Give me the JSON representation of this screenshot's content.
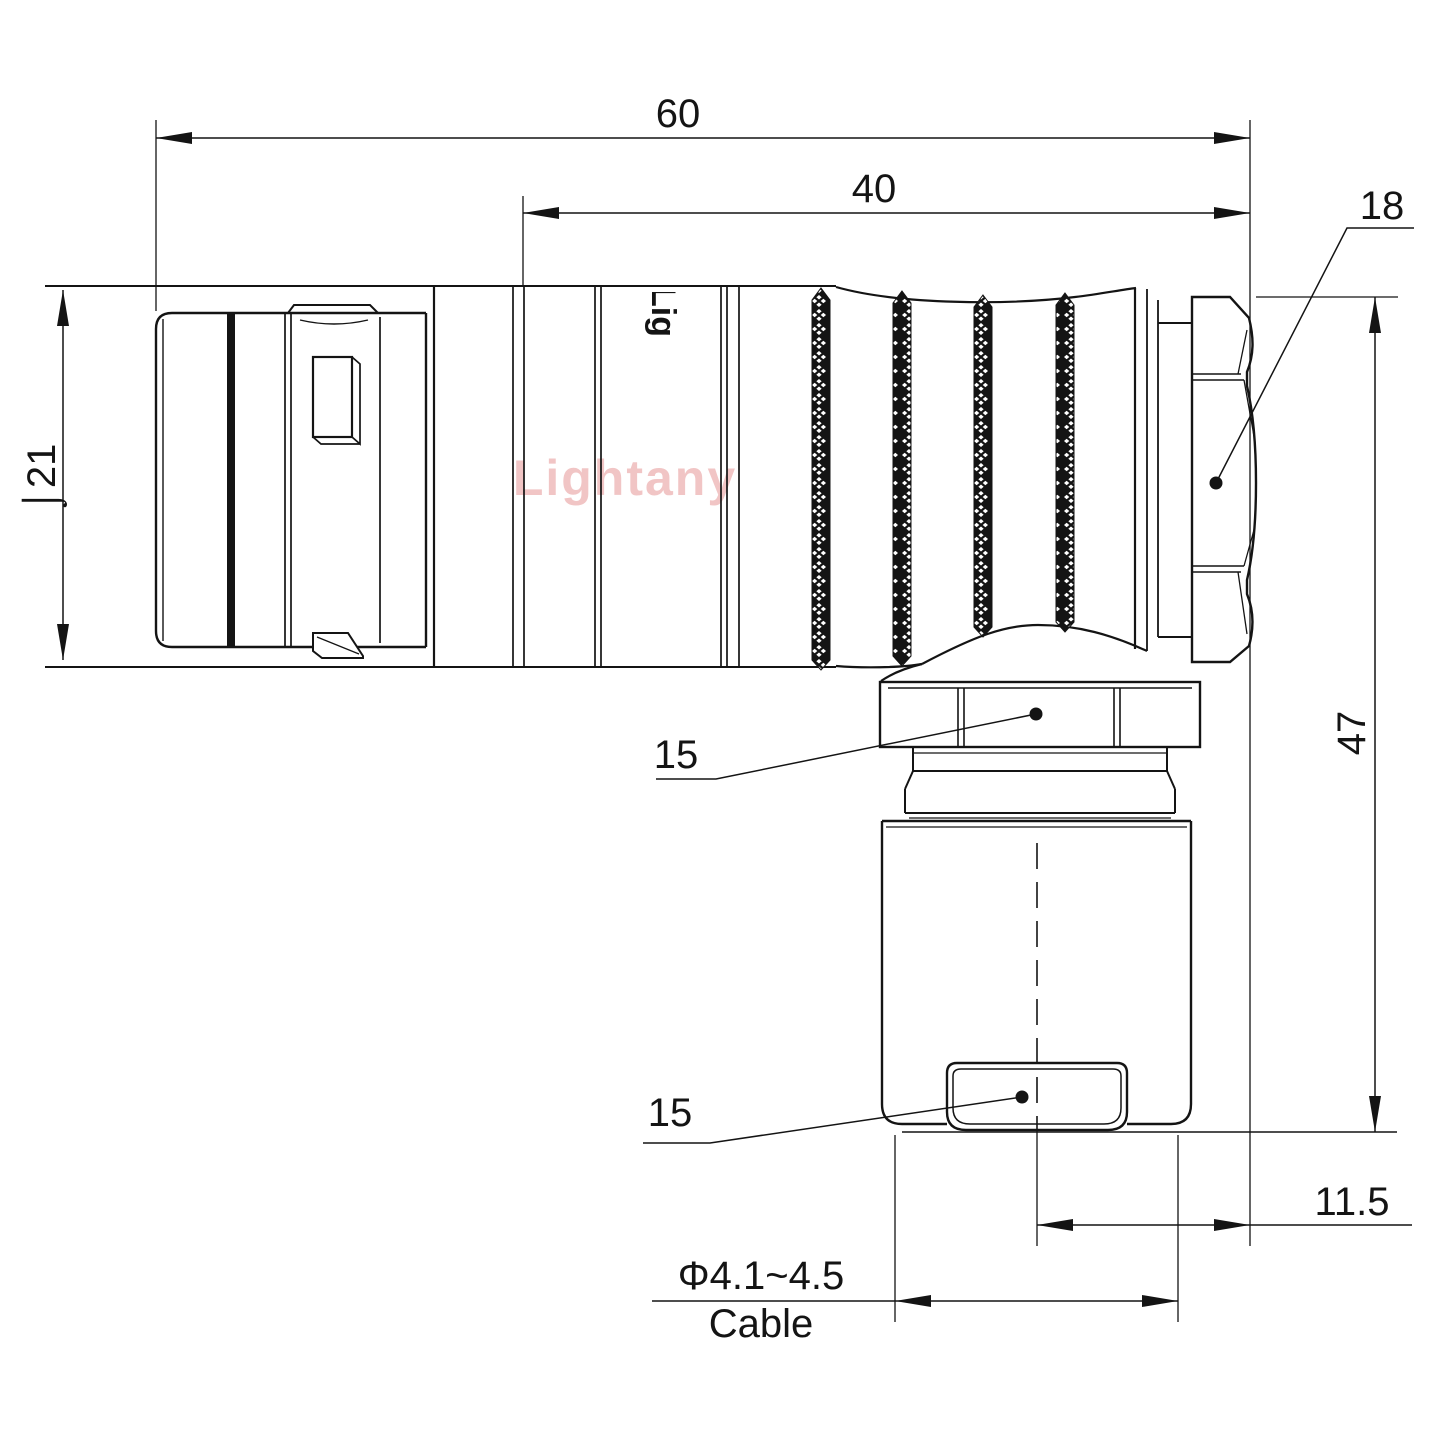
{
  "watermark": {
    "text": "Lightany",
    "color": "#d95c5c"
  },
  "body_logo": "Lig",
  "dims": {
    "overall_length": "60",
    "rear_length": "40",
    "front_diameter": "⌡21",
    "backnut_width": "18",
    "overall_height": "47",
    "elbow_nut_size": "15",
    "clamp_size": "15",
    "cable_axis_offset": "11.5",
    "cable_diameter_range": "Φ4.1~4.5",
    "cable_word": "Cable"
  },
  "colors": {
    "line": "#141414",
    "background": "#ffffff"
  }
}
